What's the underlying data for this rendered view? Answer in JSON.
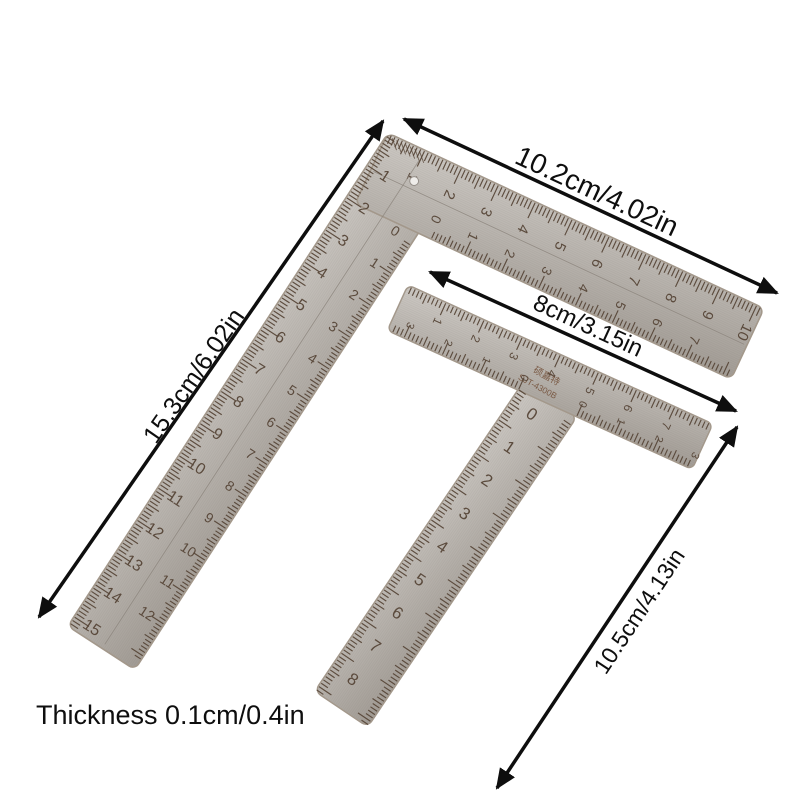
{
  "product_labels": {
    "top_arm_length": "10.2cm/4.02in",
    "left_arm_length": "15.3cm/6.02in",
    "crossbar_length": "8cm/3.15in",
    "stem_length": "10.5cm/4.13in",
    "thickness": "Thickness 0.1cm/0.4in"
  },
  "l_square_ruler": {
    "outer_top_scale_cm": [
      1,
      2,
      3,
      4,
      5,
      6,
      7,
      8,
      9,
      10
    ],
    "inner_top_scale_cm": [
      0,
      1,
      2,
      3,
      4,
      5,
      6,
      7
    ],
    "outer_left_scale_cm": [
      1,
      2,
      3,
      4,
      5,
      6,
      7,
      8,
      9,
      10,
      11,
      12,
      13,
      14,
      15
    ],
    "inner_left_scale_cm": [
      0,
      1,
      2,
      3,
      4,
      5,
      6,
      7,
      8,
      9,
      10,
      11,
      12
    ]
  },
  "t_square_ruler": {
    "crossbar_top_scale_cm": [
      1,
      2,
      3,
      4,
      5,
      6,
      7
    ],
    "crossbar_bottom_left_scale_cm": [
      0,
      1,
      2,
      3
    ],
    "crossbar_bottom_right_scale_cm": [
      0,
      1,
      2,
      3
    ],
    "stem_scale_cm": [
      0,
      1,
      2,
      3,
      4,
      5,
      6,
      7,
      8
    ],
    "brand_chinese": "硕嘉特",
    "brand_model": "SJT-4300B"
  },
  "colors": {
    "background": "#ffffff",
    "metal_light": "#cdc9c4",
    "metal_mid": "#b5b0aa",
    "metal_dark": "#a19b94",
    "metal_edge": "#a3988b",
    "engraving": "#584739",
    "brand": "#7a5a45",
    "annotation": "#0e0e0e",
    "hole_fill": "#efedea"
  }
}
